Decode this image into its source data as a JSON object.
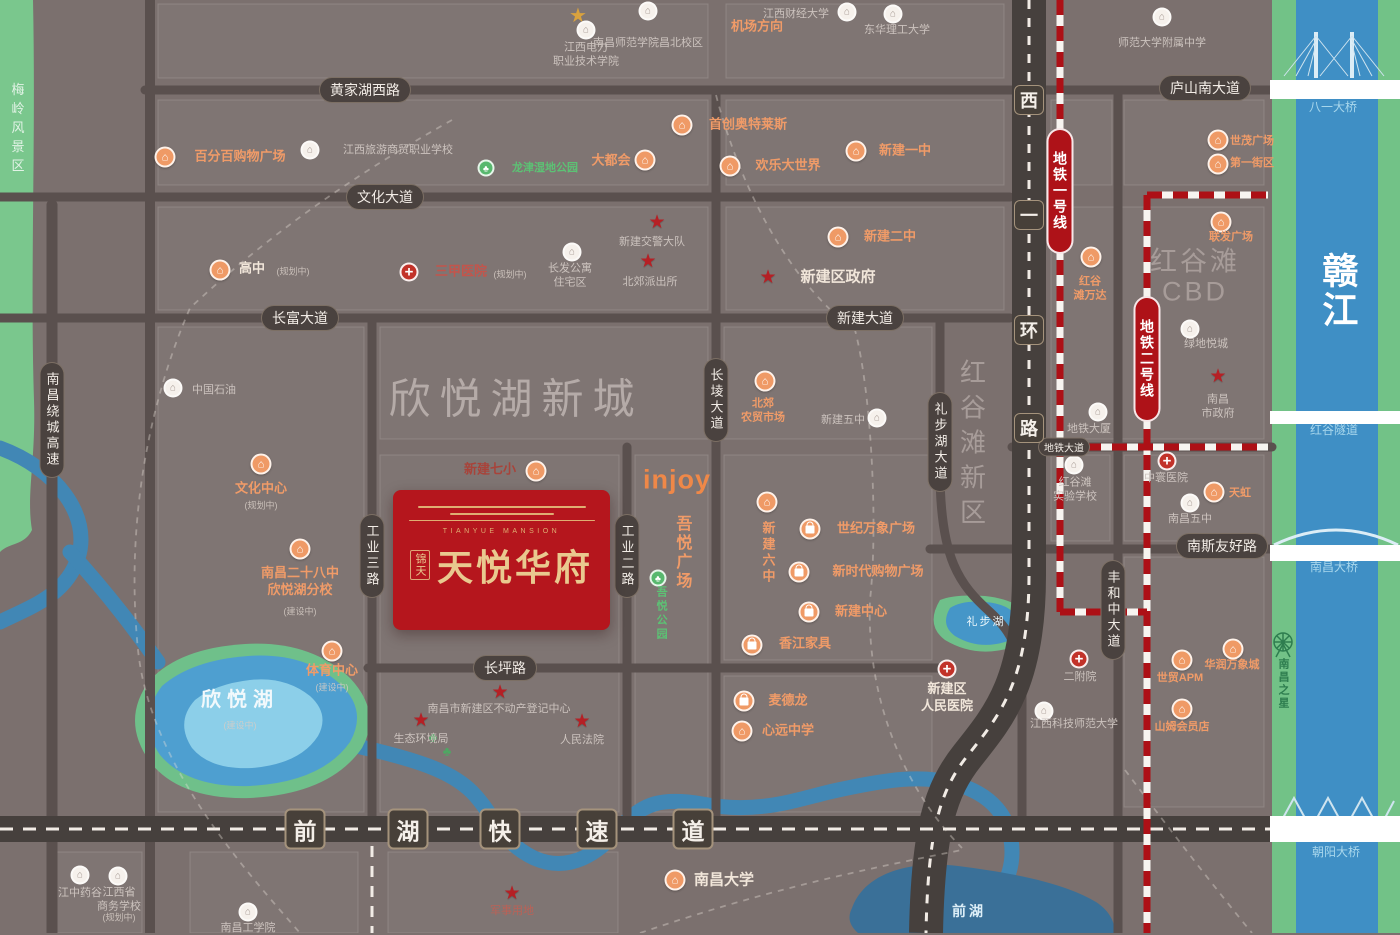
{
  "project": {
    "en": "TIANYUE MANSION",
    "prefix": "锦天",
    "name": "天悦华府"
  },
  "icons": {
    "building": "⌂",
    "school": "⌂",
    "star": "★",
    "park": "♣",
    "cross": "+",
    "landmark": "★",
    "tree": "♣"
  },
  "roads": {
    "pills_h": [
      {
        "text": "黄家湖西路",
        "x": 365,
        "y": 90
      },
      {
        "text": "庐山南大道",
        "x": 1205,
        "y": 88
      },
      {
        "text": "文化大道",
        "x": 385,
        "y": 197
      },
      {
        "text": "长富大道",
        "x": 300,
        "y": 318
      },
      {
        "text": "新建大道",
        "x": 865,
        "y": 318
      },
      {
        "text": "南斯友好路",
        "x": 1222,
        "y": 546
      },
      {
        "text": "长坪路",
        "x": 505,
        "y": 668
      },
      {
        "text": "地铁大道",
        "x": 1064,
        "y": 447,
        "small": true
      }
    ],
    "pills_v": [
      {
        "text": "南昌绕城高速",
        "x": 52,
        "y": 420
      },
      {
        "text": "工业三路",
        "x": 372,
        "y": 556
      },
      {
        "text": "工业二路",
        "x": 627,
        "y": 556
      },
      {
        "text": "长堎大道",
        "x": 716,
        "y": 400
      },
      {
        "text": "礼步湖大道",
        "x": 940,
        "y": 442
      },
      {
        "text": "丰和中大道",
        "x": 1113,
        "y": 610
      }
    ],
    "xihuan": {
      "x": 1029,
      "chars": [
        {
          "c": "西",
          "y": 100
        },
        {
          "c": "一",
          "y": 215
        },
        {
          "c": "环",
          "y": 330
        },
        {
          "c": "路",
          "y": 428
        }
      ]
    },
    "qianhu": {
      "y": 829,
      "chars": [
        {
          "c": "前",
          "x": 305
        },
        {
          "c": "湖",
          "x": 408
        },
        {
          "c": "快",
          "x": 500
        },
        {
          "c": "速",
          "x": 597
        },
        {
          "c": "道",
          "x": 693
        }
      ]
    }
  },
  "metro": [
    {
      "label": "地铁一号线",
      "x": 1060,
      "y": 128,
      "h": 126
    },
    {
      "label": "地铁二号线",
      "x": 1147,
      "y": 296,
      "h": 126
    }
  ],
  "bridges": [
    {
      "text": "八一大桥",
      "x": 1333,
      "y": 108
    },
    {
      "text": "红谷隧道",
      "x": 1334,
      "y": 431
    },
    {
      "text": "南昌大桥",
      "x": 1334,
      "y": 568
    },
    {
      "text": "朝阳大桥",
      "x": 1336,
      "y": 853
    }
  ],
  "water_labels": [
    {
      "text": "欣悦湖",
      "x": 240,
      "y": 700,
      "cls": "wl-lake-big",
      "sub": "(建设中)",
      "sx": 240,
      "sy": 725
    },
    {
      "text": "礼步湖",
      "x": 986,
      "y": 622,
      "cls": "wl-lake-sm"
    },
    {
      "text": "前湖",
      "x": 969,
      "y": 911,
      "cls": "wl-lake-md"
    },
    {
      "text": "赣江",
      "x": 1337,
      "y": 291,
      "cls": "wl-river",
      "v": true
    }
  ],
  "area_labels": [
    {
      "text": "梅岭风景区",
      "x": 17,
      "y": 130,
      "cls": "al-green",
      "v": true
    },
    {
      "text": "欣悦湖新城",
      "x": 516,
      "y": 396,
      "cls": "al-huge"
    },
    {
      "text": "红谷滩",
      "x": 1195,
      "y": 259,
      "cls": "al-big"
    },
    {
      "text": "CBD",
      "x": 1195,
      "y": 292,
      "cls": "al-big"
    },
    {
      "text": "红谷滩新区",
      "x": 972,
      "y": 446,
      "cls": "al-bigv",
      "v": true
    },
    {
      "text": "南昌之星",
      "x": 1283,
      "y": 684,
      "cls": "al-ferris",
      "v": true
    },
    {
      "text": "机场方向",
      "x": 757,
      "y": 25,
      "cls": "al-orange"
    }
  ],
  "pois": [
    {
      "t": "gold",
      "x": 578,
      "y": 15
    },
    {
      "t": "w",
      "x": 648,
      "y": 11,
      "lines": [
        "南昌师范学院昌北校区"
      ],
      "tx": 648,
      "ty": 43,
      "c": "c-gy",
      "small": true
    },
    {
      "t": "w",
      "x": 847,
      "y": 12,
      "lines": [
        "江西财经大学"
      ],
      "tx": 796,
      "ty": 14,
      "c": "c-gy",
      "small": true
    },
    {
      "t": "w",
      "x": 893,
      "y": 14,
      "lines": [
        "东华理工大学"
      ],
      "tx": 897,
      "ty": 30,
      "c": "c-gy",
      "small": true
    },
    {
      "t": "w",
      "x": 586,
      "y": 30,
      "lines": [
        "江西电力",
        "职业技术学院"
      ],
      "tx": 586,
      "ty": 55,
      "c": "c-gy",
      "small": true
    },
    {
      "t": "w",
      "x": 1162,
      "y": 17,
      "lines": [
        "师范大学附属中学"
      ],
      "tx": 1162,
      "ty": 43,
      "c": "c-gy",
      "small": true
    },
    {
      "t": "o",
      "x": 165,
      "y": 157,
      "lines": [
        "百分百购物广场"
      ],
      "tx": 240,
      "ty": 157,
      "c": "c-or"
    },
    {
      "t": "w",
      "x": 310,
      "y": 150,
      "lines": [
        "江西旅游商贸职业学校"
      ],
      "tx": 398,
      "ty": 150,
      "c": "c-gy",
      "small": true
    },
    {
      "t": "o",
      "x": 682,
      "y": 125,
      "lines": [
        "首创奥特莱斯"
      ],
      "tx": 748,
      "ty": 125,
      "c": "c-or"
    },
    {
      "t": "o",
      "x": 645,
      "y": 160,
      "lines": [
        "大都会"
      ],
      "tx": 611,
      "ty": 161,
      "c": "c-or"
    },
    {
      "t": "o",
      "x": 730,
      "y": 166,
      "lines": [
        "欢乐大世界"
      ],
      "tx": 788,
      "ty": 166,
      "c": "c-or"
    },
    {
      "t": "o",
      "x": 856,
      "y": 151,
      "lines": [
        "新建一中"
      ],
      "tx": 905,
      "ty": 151,
      "c": "c-or"
    },
    {
      "t": "g",
      "x": 486,
      "y": 168,
      "lines": [
        "龙津湿地公园"
      ],
      "tx": 545,
      "ty": 168,
      "c": "c-gn",
      "small": true
    },
    {
      "t": "o",
      "x": 220,
      "y": 270,
      "lines": [
        "高中"
      ],
      "tx": 252,
      "ty": 269,
      "c": "c-wh",
      "sub": "(规划中)",
      "sx": 293,
      "sy": 271
    },
    {
      "t": "c",
      "x": 409,
      "y": 272,
      "lines": [
        "三甲医院"
      ],
      "tx": 461,
      "ty": 272,
      "c": "c-rd",
      "sub": "(规划中)",
      "sx": 510,
      "sy": 274
    },
    {
      "t": "s",
      "x": 657,
      "y": 222,
      "lines": [
        "新建交警大队"
      ],
      "tx": 652,
      "ty": 242,
      "c": "c-gy",
      "small": true
    },
    {
      "t": "w",
      "x": 572,
      "y": 252,
      "lines": [
        "长发公寓",
        "住宅区"
      ],
      "tx": 570,
      "ty": 276,
      "c": "c-gy",
      "small": true
    },
    {
      "t": "s",
      "x": 648,
      "y": 261,
      "lines": [
        "北郊派出所"
      ],
      "tx": 650,
      "ty": 282,
      "c": "c-gy",
      "small": true
    },
    {
      "t": "o",
      "x": 838,
      "y": 237,
      "lines": [
        "新建二中"
      ],
      "tx": 890,
      "ty": 237,
      "c": "c-or"
    },
    {
      "t": "s",
      "x": 768,
      "y": 277,
      "lines": [
        "新建区政府"
      ],
      "tx": 838,
      "ty": 277,
      "c": "c-wh",
      "fs": 15
    },
    {
      "t": "w",
      "x": 173,
      "y": 388,
      "lines": [
        "中国石油"
      ],
      "tx": 214,
      "ty": 390,
      "c": "c-gy",
      "small": true
    },
    {
      "t": "o",
      "x": 261,
      "y": 464,
      "lines": [
        "文化中心"
      ],
      "tx": 261,
      "ty": 489,
      "c": "c-or",
      "sub": "(规划中)",
      "sx": 261,
      "sy": 505
    },
    {
      "t": "o",
      "x": 300,
      "y": 549,
      "lines": [
        "南昌二十八中",
        "欣悦湖分校"
      ],
      "tx": 300,
      "ty": 582,
      "c": "c-or",
      "sub": "(建设中)",
      "sx": 300,
      "sy": 611
    },
    {
      "t": "o",
      "x": 332,
      "y": 651,
      "lines": [
        "体育中心"
      ],
      "tx": 332,
      "ty": 671,
      "c": "c-or",
      "sub": "(建设中)",
      "sx": 332,
      "sy": 687
    },
    {
      "t": "o",
      "x": 765,
      "y": 381,
      "lines": [
        "北郊",
        "农贸市场"
      ],
      "tx": 763,
      "ty": 411,
      "c": "c-or",
      "small": true
    },
    {
      "t": "w",
      "x": 877,
      "y": 418,
      "lines": [
        "新建五中"
      ],
      "tx": 843,
      "ty": 420,
      "c": "c-gy",
      "small": true
    },
    {
      "t": "o",
      "x": 1091,
      "y": 257,
      "lines": [
        "红谷",
        "滩万达"
      ],
      "tx": 1090,
      "ty": 289,
      "c": "c-or",
      "small": true
    },
    {
      "t": "w",
      "x": 1190,
      "y": 329,
      "lines": [
        "绿地悦城"
      ],
      "tx": 1206,
      "ty": 344,
      "c": "c-gy",
      "small": true
    },
    {
      "t": "s",
      "x": 1218,
      "y": 376,
      "lines": [
        "南昌",
        "市政府"
      ],
      "tx": 1218,
      "ty": 407,
      "c": "c-gy",
      "small": true
    },
    {
      "t": "w",
      "x": 1098,
      "y": 412,
      "lines": [
        "地铁大厦"
      ],
      "tx": 1089,
      "ty": 429,
      "c": "c-gy",
      "small": true
    },
    {
      "t": "o",
      "x": 1218,
      "y": 140,
      "lines": [
        "世茂广场"
      ],
      "tx": 1252,
      "ty": 141,
      "c": "c-or",
      "small": true
    },
    {
      "t": "o",
      "x": 1218,
      "y": 164,
      "lines": [
        "第一街区"
      ],
      "tx": 1252,
      "ty": 163,
      "c": "c-or",
      "small": true
    },
    {
      "t": "o",
      "x": 1221,
      "y": 222,
      "lines": [
        "联发广场"
      ],
      "tx": 1231,
      "ty": 237,
      "c": "c-or",
      "small": true
    },
    {
      "t": "o",
      "x": 536,
      "y": 471,
      "lines": [
        "新建七小"
      ],
      "tx": 490,
      "ty": 470,
      "c": "c-rd2"
    },
    {
      "t": "t",
      "lines": [
        "injoy"
      ],
      "tx": 677,
      "ty": 480,
      "c": "c-injoy"
    },
    {
      "t": "t",
      "lines": [
        "吾悦广场"
      ],
      "tx": 681,
      "ty": 553,
      "c": "c-or",
      "v": true,
      "fs": 16
    },
    {
      "t": "g",
      "x": 658,
      "y": 578,
      "lines": [
        "吾悦公园"
      ],
      "tx": 661,
      "ty": 614,
      "c": "c-gn",
      "v": true,
      "small": true
    },
    {
      "t": "o",
      "x": 767,
      "y": 502,
      "lines": [
        "新建六中"
      ],
      "tx": 767,
      "ty": 553,
      "c": "c-or",
      "v": true
    },
    {
      "t": "b",
      "x": 810,
      "y": 529,
      "lines": [
        "世纪万象广场"
      ],
      "tx": 876,
      "ty": 529,
      "c": "c-or"
    },
    {
      "t": "b",
      "x": 799,
      "y": 572,
      "lines": [
        "新时代购物广场"
      ],
      "tx": 878,
      "ty": 572,
      "c": "c-or"
    },
    {
      "t": "b",
      "x": 809,
      "y": 612,
      "lines": [
        "新建中心"
      ],
      "tx": 861,
      "ty": 612,
      "c": "c-or"
    },
    {
      "t": "b",
      "x": 752,
      "y": 645,
      "lines": [
        "香江家具"
      ],
      "tx": 805,
      "ty": 644,
      "c": "c-or"
    },
    {
      "t": "w",
      "x": 1074,
      "y": 465,
      "lines": [
        "红谷滩",
        "实验学校"
      ],
      "tx": 1075,
      "ty": 490,
      "c": "c-gy",
      "small": true
    },
    {
      "t": "c",
      "x": 1167,
      "y": 461,
      "lines": [
        "中寰医院"
      ],
      "tx": 1166,
      "ty": 478,
      "c": "c-gy",
      "small": true
    },
    {
      "t": "w",
      "x": 1190,
      "y": 503,
      "lines": [
        "南昌五中"
      ],
      "tx": 1190,
      "ty": 519,
      "c": "c-gy",
      "small": true
    },
    {
      "t": "o",
      "x": 1214,
      "y": 492,
      "lines": [
        "天虹"
      ],
      "tx": 1240,
      "ty": 493,
      "c": "c-or",
      "small": true
    },
    {
      "t": "c",
      "x": 1079,
      "y": 659,
      "lines": [
        "二附院"
      ],
      "tx": 1080,
      "ty": 677,
      "c": "c-gy",
      "small": true
    },
    {
      "t": "o",
      "x": 1182,
      "y": 660,
      "lines": [
        "世贸APM"
      ],
      "tx": 1180,
      "ty": 678,
      "c": "c-or",
      "small": true
    },
    {
      "t": "o",
      "x": 1233,
      "y": 649,
      "lines": [
        "华润万象城"
      ],
      "tx": 1232,
      "ty": 665,
      "c": "c-or",
      "small": true
    },
    {
      "t": "o",
      "x": 1182,
      "y": 709,
      "lines": [
        "山姆会员店"
      ],
      "tx": 1182,
      "ty": 727,
      "c": "c-or",
      "small": true
    },
    {
      "t": "c",
      "x": 947,
      "y": 669,
      "lines": [
        "新建区",
        "人民医院"
      ],
      "tx": 947,
      "ty": 698,
      "c": "c-wh"
    },
    {
      "t": "b",
      "x": 744,
      "y": 701,
      "lines": [
        "麦德龙"
      ],
      "tx": 788,
      "ty": 701,
      "c": "c-or"
    },
    {
      "t": "o",
      "x": 742,
      "y": 731,
      "lines": [
        "心远中学"
      ],
      "tx": 788,
      "ty": 731,
      "c": "c-or"
    },
    {
      "t": "s",
      "x": 500,
      "y": 692,
      "lines": [
        "南昌市新建区不动产登记中心"
      ],
      "tx": 499,
      "ty": 709,
      "c": "c-gy",
      "small": true
    },
    {
      "t": "s",
      "x": 421,
      "y": 720,
      "lines": [
        "生态环境局"
      ],
      "tx": 421,
      "ty": 739,
      "c": "c-gy",
      "small": true
    },
    {
      "t": "s",
      "x": 582,
      "y": 721,
      "lines": [
        "人民法院"
      ],
      "tx": 582,
      "ty": 740,
      "c": "c-gy",
      "small": true
    },
    {
      "t": "w",
      "x": 1044,
      "y": 711,
      "lines": [
        "江西科技师范大学"
      ],
      "tx": 1074,
      "ty": 724,
      "c": "c-gy",
      "small": true
    },
    {
      "t": "s",
      "x": 512,
      "y": 893,
      "lines": [
        "军事用地"
      ],
      "tx": 512,
      "ty": 911,
      "c": "c-rd3",
      "small": true
    },
    {
      "t": "o",
      "x": 675,
      "y": 880,
      "lines": [
        "南昌大学"
      ],
      "tx": 724,
      "ty": 880,
      "c": "c-wh",
      "fs": 15
    },
    {
      "t": "w",
      "x": 80,
      "y": 875,
      "lines": [
        "江中药谷"
      ],
      "tx": 80,
      "ty": 893,
      "c": "c-gy",
      "small": true
    },
    {
      "t": "w",
      "x": 118,
      "y": 876,
      "lines": [
        "江西省",
        "商务学校"
      ],
      "tx": 119,
      "ty": 900,
      "c": "c-gy",
      "small": true,
      "sub": "(规划中)",
      "sx": 119,
      "sy": 917
    },
    {
      "t": "w",
      "x": 248,
      "y": 912,
      "lines": [
        "南昌工学院"
      ],
      "tx": 248,
      "ty": 928,
      "c": "c-gy",
      "small": true
    }
  ],
  "deco_trees": [
    {
      "x": 433,
      "y": 737
    },
    {
      "x": 447,
      "y": 751
    }
  ]
}
